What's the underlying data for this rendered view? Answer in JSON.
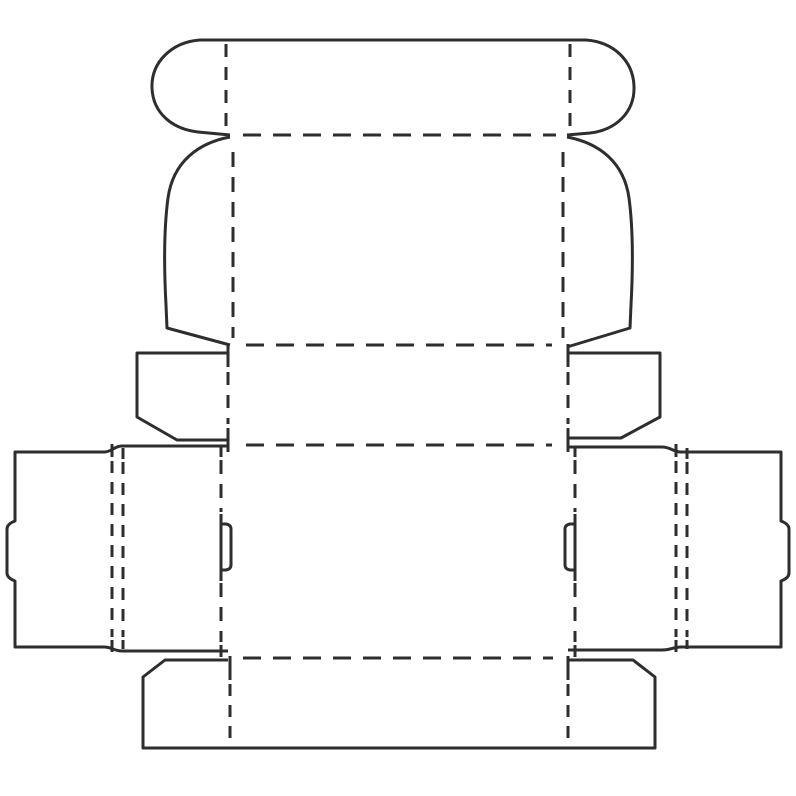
{
  "diagram": {
    "name": "carton-box-dieline",
    "canvas": {
      "width": 796,
      "height": 796
    },
    "style": {
      "background": "#ffffff",
      "stroke": "#2e2e2e",
      "stroke_width": 3
    },
    "cut_lines": [
      {
        "name": "tuck-flap-outline",
        "d": "M 230 135 L 198 132 C 172 129 153 113 152 88 C 151 62 172 42 200 40 L 586 40 C 614 42 633 61 634 86 C 635 112 616 130 590 133 L 567 135"
      },
      {
        "name": "lid-panel-left-curve",
        "d": "M 230 137 C 198 143 173 162 168 198 C 164 228 164 268 166 305 L 167 328 L 230 345"
      },
      {
        "name": "lid-panel-right-curve",
        "d": "M 567 137 C 599 143 624 162 629 198 C 633 228 633 268 631 305 L 630 328 L 567 347"
      },
      {
        "name": "left-dust-flap-outline",
        "d": "M 228 353 L 137 353 L 137 417 L 177 440 L 228 440"
      },
      {
        "name": "right-dust-flap-outline",
        "d": "M 568 353 L 660 353 L 660 417 L 621 438 L 568 438"
      },
      {
        "name": "left-dust-fold-solid-ends",
        "d": "M 228 344 L 228 367 M 228 428 L 228 452"
      },
      {
        "name": "right-dust-fold-solid-ends",
        "d": "M 568 344 L 568 367 M 568 428 L 568 452"
      },
      {
        "name": "left-wing-top-edge",
        "d": "M 228 446 L 122 446 C 114 446 112 452 104 452"
      },
      {
        "name": "left-wing-bottom-edge",
        "d": "M 228 651 L 122 651 C 114 651 112 647 104 647"
      },
      {
        "name": "right-wing-top-edge",
        "d": "M 568 447 L 662 447 C 671 447 673 452 681 452 L 691 452"
      },
      {
        "name": "right-wing-bottom-edge",
        "d": "M 568 650 L 662 650 C 671 650 673 647 681 647 L 691 647"
      },
      {
        "name": "left-glue-flap-outline",
        "d": "M 105 452 L 15 452 L 15 521 Q 7 524 7 529 L 7 573 Q 7 578 15 581 L 15 647 L 105 647"
      },
      {
        "name": "right-glue-flap-outline",
        "d": "M 690 452 L 781 452 L 781 521 Q 789 524 789 529 L 789 573 Q 789 578 781 581 L 781 647 L 690 647"
      },
      {
        "name": "left-glue-fold-solid-tips",
        "d": "M 112 444 L 112 457 M 123 448 L 123 459 M 112 640 L 112 652 M 123 640 L 123 649"
      },
      {
        "name": "right-glue-fold-solid-tips",
        "d": "M 676 444 L 676 457 M 687 448 L 687 459 M 676 640 L 676 652 M 687 640 L 687 649"
      },
      {
        "name": "left-lock-slit",
        "d": "M 221 514 L 221 581 M 221 524 L 226 524 Q 231 525 231 529 L 231 565 Q 231 569 226 570 L 221 570"
      },
      {
        "name": "right-lock-slit",
        "d": "M 575 514 L 575 581 M 575 524 L 570 524 Q 565 525 565 529 L 565 565 Q 565 569 570 570 L 575 570"
      },
      {
        "name": "main-fold-left-solid-tips",
        "d": "M 221 446 L 221 457 M 221 645 L 221 657"
      },
      {
        "name": "main-fold-right-solid-tips",
        "d": "M 575 447 L 575 457 M 575 645 L 575 657"
      },
      {
        "name": "bottom-fold-solid-starts",
        "d": "M 230 656 L 230 680 M 568 656 L 568 680"
      },
      {
        "name": "bottom-flap-outline",
        "d": "M 228 660 L 165 660 L 143 677 L 143 748 L 655 748 L 655 677 L 633 660 L 568 660"
      }
    ],
    "fold_lines": [
      {
        "name": "tuck-flap-fold-left-vertical",
        "d": "M 226 44 L 226 130",
        "dash": "13 10"
      },
      {
        "name": "tuck-flap-fold-right-vertical",
        "d": "M 570 44 L 570 130",
        "dash": "13 10"
      },
      {
        "name": "tuck-to-lid-fold",
        "d": "M 243 135 L 556 135",
        "dash": "18 12"
      },
      {
        "name": "lid-fold-left-vertical",
        "d": "M 233 152 L 233 338",
        "dash": "15 10"
      },
      {
        "name": "lid-fold-right-vertical",
        "d": "M 563 152 L 563 338",
        "dash": "15 10"
      },
      {
        "name": "lid-to-neck-fold",
        "d": "M 246 345 L 552 345",
        "dash": "18 12"
      },
      {
        "name": "left-dust-fold-dashed",
        "d": "M 228 372 L 228 424",
        "dash": "13 10"
      },
      {
        "name": "right-dust-fold-dashed",
        "d": "M 568 372 L 568 424",
        "dash": "13 10"
      },
      {
        "name": "neck-to-main-fold",
        "d": "M 246 445 L 552 445",
        "dash": "18 12"
      },
      {
        "name": "left-glue-fold-dashed-outer",
        "d": "M 112 461 L 112 637",
        "dash": "12 9"
      },
      {
        "name": "left-glue-fold-dashed-inner",
        "d": "M 123 462 L 123 637",
        "dash": "12 9"
      },
      {
        "name": "right-glue-fold-dashed-outer",
        "d": "M 676 461 L 676 637",
        "dash": "12 9"
      },
      {
        "name": "right-glue-fold-dashed-inner",
        "d": "M 687 462 L 687 637",
        "dash": "12 9"
      },
      {
        "name": "main-fold-left-upper",
        "d": "M 221 460 L 221 512",
        "dash": "14 10"
      },
      {
        "name": "main-fold-left-lower",
        "d": "M 221 583 L 221 642",
        "dash": "14 10"
      },
      {
        "name": "main-fold-right-upper",
        "d": "M 575 460 L 575 512",
        "dash": "14 10"
      },
      {
        "name": "main-fold-right-lower",
        "d": "M 575 583 L 575 642",
        "dash": "14 10"
      },
      {
        "name": "main-to-bottom-fold",
        "d": "M 243 658 L 553 658",
        "dash": "18 12"
      },
      {
        "name": "bottom-flap-fold-left",
        "d": "M 230 684 L 230 746",
        "dash": "12 9"
      },
      {
        "name": "bottom-flap-fold-right",
        "d": "M 568 684 L 568 746",
        "dash": "12 9"
      }
    ]
  }
}
